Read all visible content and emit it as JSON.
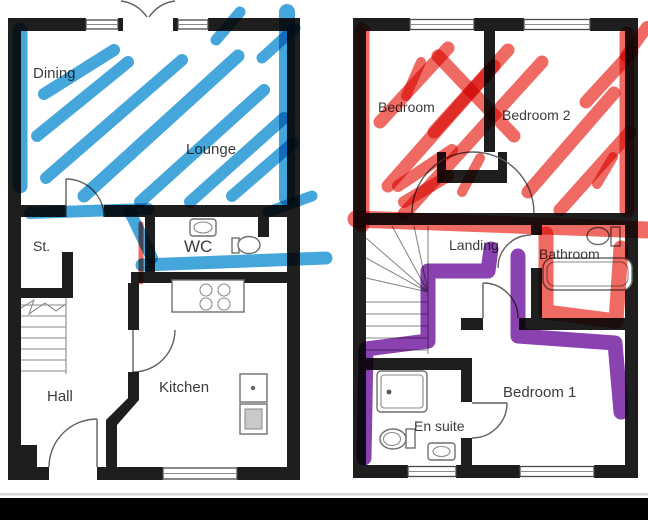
{
  "colors": {
    "marker_blue": "#2f9cd6",
    "marker_red": "#ee5a52",
    "marker_purple": "#7c2da6",
    "wall": "#1e1e1e",
    "letterbox": "#000000",
    "label_text": "#3c3c3c"
  },
  "ground_floor": {
    "rooms": [
      {
        "label": "Dining"
      },
      {
        "label": "Lounge"
      },
      {
        "label": "St."
      },
      {
        "label": "WC"
      },
      {
        "label": "Hall"
      },
      {
        "label": "Kitchen"
      }
    ]
  },
  "first_floor": {
    "rooms": [
      {
        "label": "Bedroom"
      },
      {
        "label": "Bedroom 2"
      },
      {
        "label": "Landing"
      },
      {
        "label": "Bathroom"
      },
      {
        "label": "Bedroom 1"
      },
      {
        "label": "En suite"
      }
    ]
  }
}
